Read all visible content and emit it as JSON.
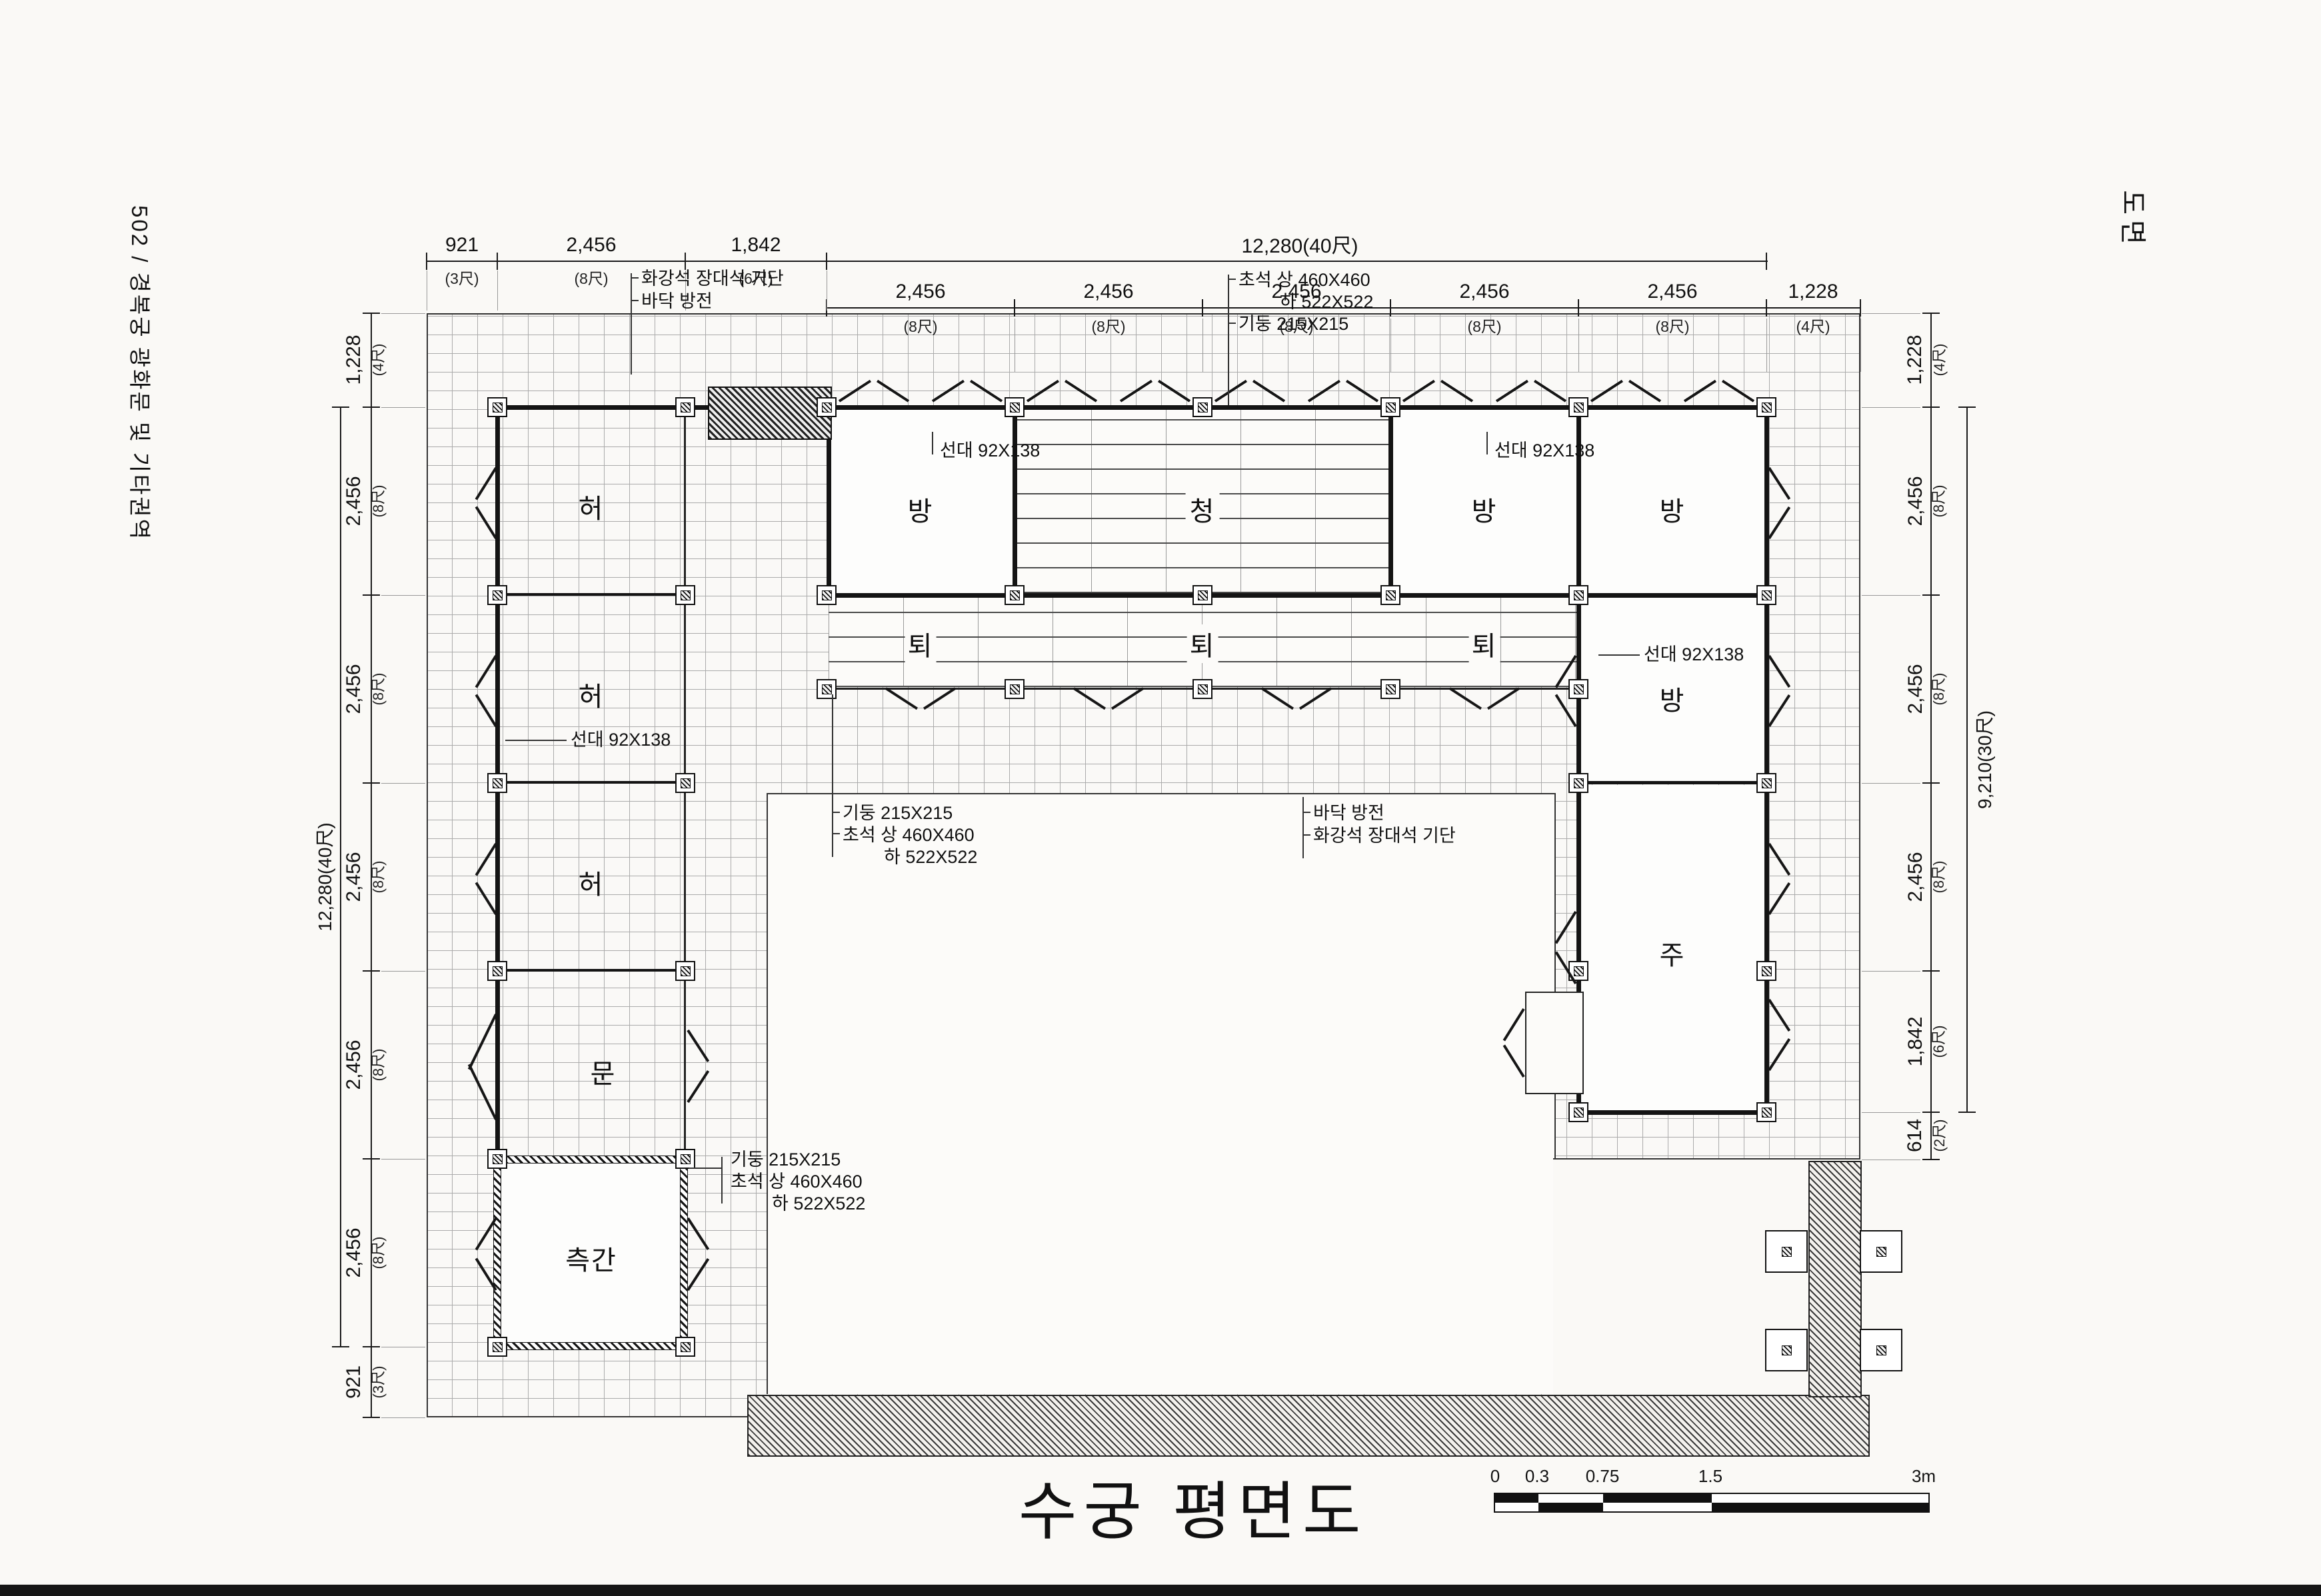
{
  "page": {
    "left_margin": "502 / 경복궁 광화문 및 기타권역",
    "right_margin": "도면",
    "title": "수궁 평면도"
  },
  "scale": {
    "t0": "0",
    "t1": "0.3",
    "t2": "0.75",
    "t3": "1.5",
    "t4": "3m"
  },
  "dims": {
    "top1": [
      {
        "v": "921",
        "u": "(3尺)"
      },
      {
        "v": "2,456",
        "u": "(8尺)"
      },
      {
        "v": "1,842",
        "u": "(6尺)"
      },
      {
        "v": "12,280(40尺)",
        "u": ""
      }
    ],
    "top2": [
      {
        "v": "2,456",
        "u": "(8尺)"
      },
      {
        "v": "2,456",
        "u": "(8尺)"
      },
      {
        "v": "2,456",
        "u": "(8尺)"
      },
      {
        "v": "2,456",
        "u": "(8尺)"
      },
      {
        "v": "2,456",
        "u": "(8尺)"
      },
      {
        "v": "1,228",
        "u": "(4尺)"
      }
    ],
    "left": [
      {
        "v": "1,228",
        "u": "(4尺)"
      },
      {
        "v": "2,456",
        "u": "(8尺)"
      },
      {
        "v": "2,456",
        "u": "(8尺)"
      },
      {
        "v": "2,456",
        "u": "(8尺)"
      },
      {
        "v": "2,456",
        "u": "(8尺)"
      },
      {
        "v": "2,456",
        "u": "(8尺)"
      },
      {
        "v": "921",
        "u": "(3尺)"
      }
    ],
    "left_total": "12,280(40尺)",
    "right": [
      {
        "v": "1,228",
        "u": "(4尺)"
      },
      {
        "v": "2,456",
        "u": "(8尺)"
      },
      {
        "v": "2,456",
        "u": "(8尺)"
      },
      {
        "v": "2,456",
        "u": "(8尺)"
      },
      {
        "v": "1,842",
        "u": "(6尺)"
      },
      {
        "v": "614",
        "u": "(2尺)"
      }
    ],
    "right_total": "9,210(30尺)"
  },
  "ann": {
    "gidan": "화강석 장대석 기단",
    "bangjeon": "바닥 방전",
    "choseok_sang": "초석 상 460X460",
    "choseok_ha": "하 522X522",
    "gidung": "기둥 215X215",
    "seondae": "선대 92X138"
  },
  "rooms": {
    "heo": "허",
    "mun": "문",
    "cheukgan": "측간",
    "bang": "방",
    "cheong": "청",
    "toe": "퇴",
    "ju": "주"
  }
}
